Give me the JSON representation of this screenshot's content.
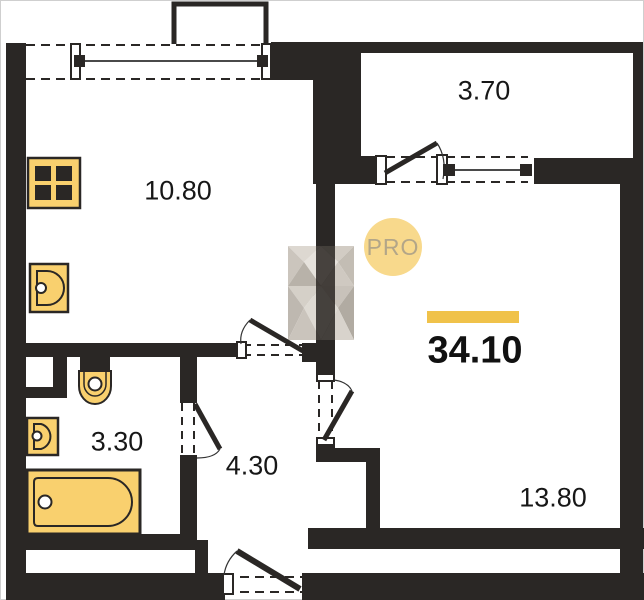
{
  "plan": {
    "type": "apartment-floor-plan",
    "badge": {
      "label": "PRO"
    },
    "total": {
      "value": "34.10"
    },
    "rooms": {
      "kitchen": {
        "area": "10.80"
      },
      "balcony": {
        "area": "3.70"
      },
      "bathroom": {
        "area": "3.30"
      },
      "hallway": {
        "area": "4.30"
      },
      "living": {
        "area": "13.80"
      }
    },
    "fixtures": [
      "stove-icon",
      "kitchen-sink-icon",
      "toilet-icon",
      "bathroom-sink-icon",
      "bathtub-icon"
    ],
    "openings": [
      "kitchen-window",
      "balcony-door",
      "balcony-window",
      "kitchen-door",
      "bathroom-door",
      "living-room-door",
      "entrance-door",
      "living-room-window"
    ]
  },
  "colors": {
    "wall": "#2a2725",
    "line": "#4a4a4a",
    "fixture": "#f9d06e",
    "accent": "#f0c24a",
    "badge_bg": "#f8d98c",
    "badge_text": "#b3a688",
    "label": "#171717"
  }
}
